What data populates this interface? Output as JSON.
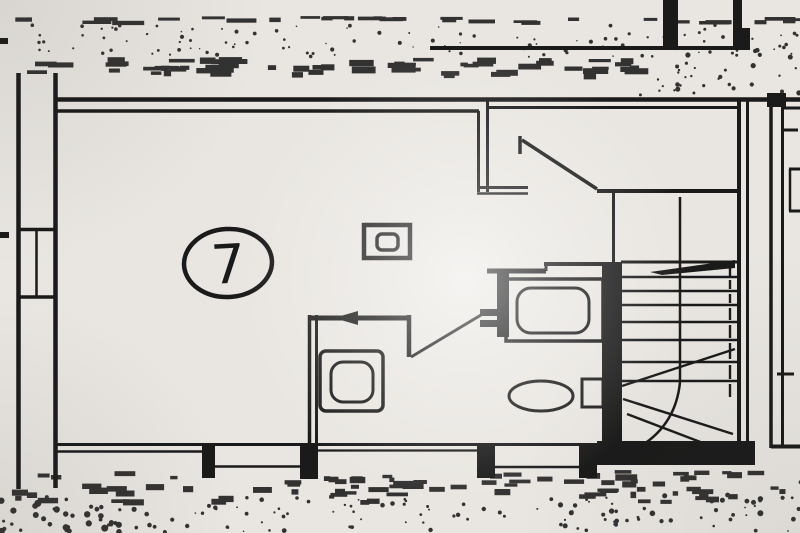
{
  "plan": {
    "room_label": "7",
    "colors": {
      "paper": "#e9e6e1",
      "ink": "#1a1a1a"
    }
  }
}
